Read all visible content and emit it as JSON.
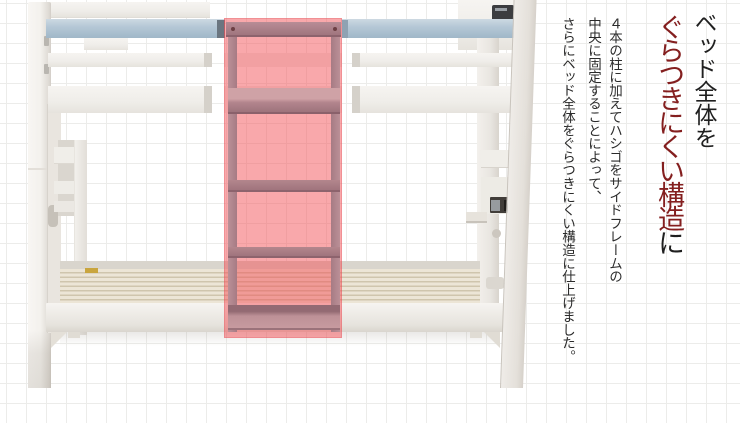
{
  "headline": {
    "line1": "ベッド全体を",
    "line2_emphasis": "ぐらつきにくい構造",
    "line2_tail": "に"
  },
  "description": {
    "line1": "４本の柱に加えてハシゴをサイドフレームの",
    "line2": "中央に固定することによって、",
    "line3": "さらにベッド全体をぐらつきにくい構造に仕上げました。"
  },
  "diagram": {
    "subject": "white-bunk-bed-front-view",
    "highlighted_part": "center-ladder-fixed-to-side-frame"
  },
  "theme": {
    "highlight": "rgba(243,81,87,0.5)",
    "rail_blue": "#b5c8d6",
    "headline_black": "#1f1f1f",
    "headline_red": "#841f1f",
    "body_text": "#2b2b2b",
    "grid_line": "#ececea",
    "slat_light": "#ece5d6",
    "slat_dark": "#cfc5ad",
    "rung_mauve": "#ab818a"
  }
}
